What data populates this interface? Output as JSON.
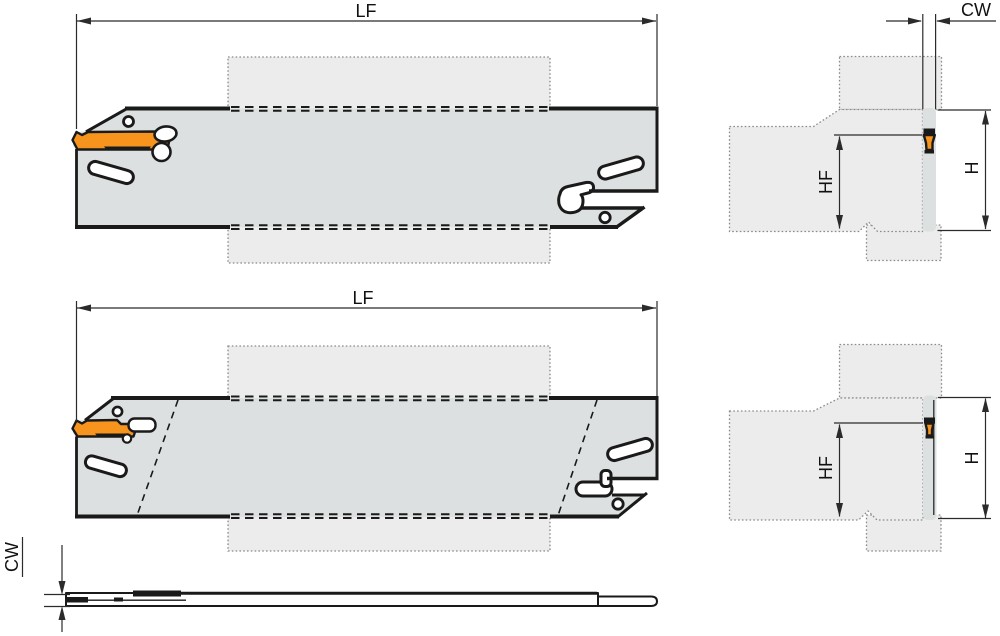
{
  "title": "Parting blade technical drawing",
  "colors": {
    "bg": "#FFFFFF",
    "insert_orange": "#F7941E",
    "blade_gray": "#DCE0E0",
    "holder_gray": "#ECECEC",
    "line_black": "#1A1A1A",
    "dim_gray": "#2B2B2B"
  },
  "figures": {
    "front_view_top": {
      "dim_lf": "LF"
    },
    "front_view_bottom": {
      "dim_lf": "LF"
    },
    "side_view_top": {
      "dim_cw": "CW",
      "dim_hf": "HF",
      "dim_h": "H"
    },
    "side_view_bottom": {
      "dim_hf": "HF",
      "dim_h": "H"
    },
    "top_view": {
      "dim_cw": "CW"
    }
  }
}
